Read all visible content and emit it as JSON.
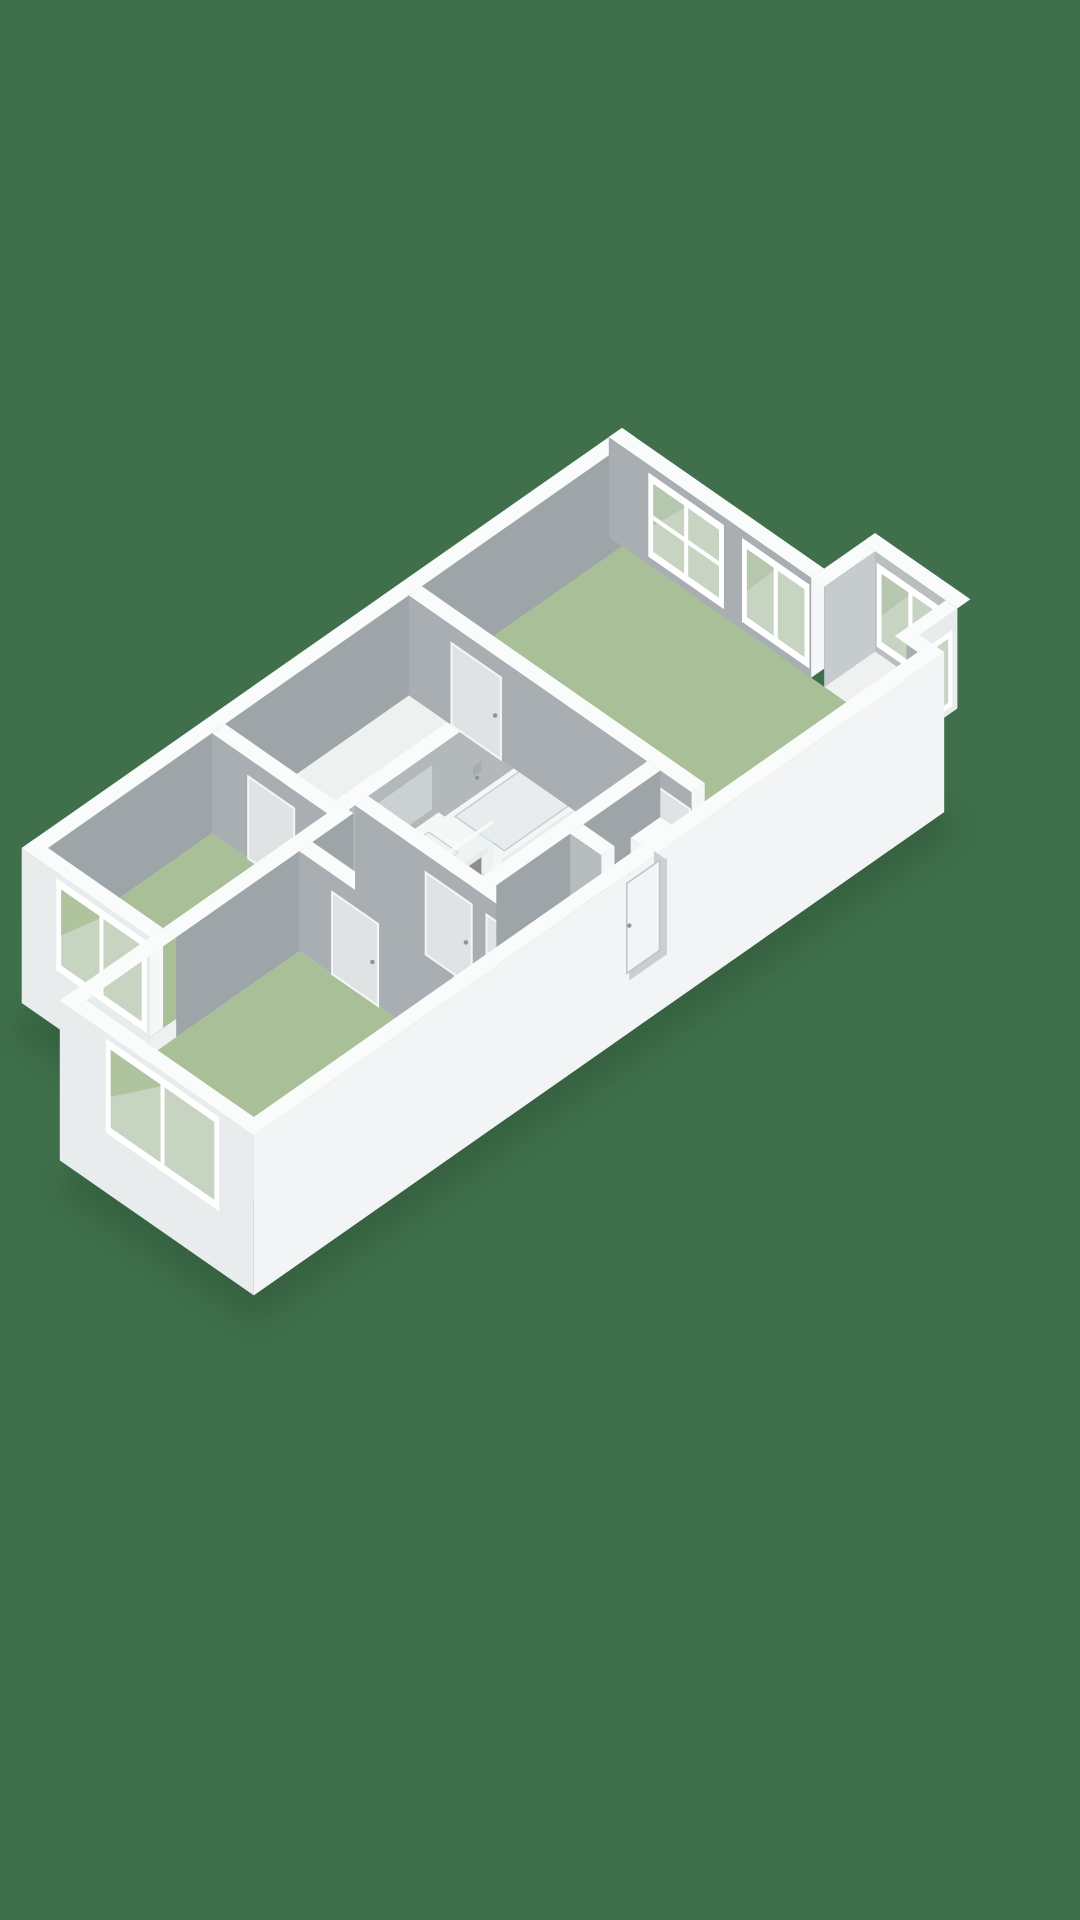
{
  "meta": {
    "title": "3D isometric floor plan"
  },
  "canvas": {
    "width": 1080,
    "height": 1920
  },
  "colors": {
    "bg": "#3F6F4B",
    "shadow": "#2C5136",
    "floor_base": "#EFF1F1",
    "floor_green": "#A9BF98",
    "floor_bath": "#D7DADB",
    "floor_tan": "#B5A893",
    "wall_top": "#FAFBFB",
    "gray_u": "#A8AEB1",
    "gray_v": "#9EA5A8",
    "gray_bath": "#B3B9BB",
    "gray_light": "#C6CCCE",
    "gray_bay": "#B9BFC1",
    "ext_sw": "#E9ECED",
    "ext_se": "#F2F4F5",
    "end_cap": "#F5F7F8",
    "frame": "#FFFFFF",
    "glass": "#C7D4C2",
    "glass_refl": "#B2C5A9",
    "door_panel": "#DFE3E4",
    "door_edge": "#F4F7F7",
    "handle": "#8F969A",
    "recess": "#C9CED0",
    "leaf": "#F2F5F5",
    "leaf_edge": "#BDC3C5",
    "tub": "#F4F6F7",
    "tub_side": "#E9EDEE",
    "basin": "#E8ECEC",
    "basin_edge": "#C8CED0",
    "vanity_front": "#453729",
    "vanity_side": "#372C21",
    "counter": "#F6F8F8",
    "counter_edge": "#E6EAEA",
    "sink": "#F0F3F3",
    "chrome": "#A7ACAF",
    "chrome_dark": "#899094",
    "glass_panel": "#E6EDEE",
    "plant": "#3E6D49",
    "plant_dot": "#86A97F",
    "cab": "#F1F4F4",
    "cab_side": "#E9EDED",
    "shelf": "#E2E8E9"
  },
  "rooms": [
    {
      "id": "living-room",
      "floor": "floor_green"
    },
    {
      "id": "bedroom-1",
      "floor": "floor_green"
    },
    {
      "id": "bedroom-2",
      "floor": "floor_green"
    },
    {
      "id": "bathroom",
      "floor": "floor_bath"
    },
    {
      "id": "closet",
      "floor": "floor_tan"
    },
    {
      "id": "hallway",
      "floor": "floor_base"
    }
  ],
  "fixtures": [
    "bathtub",
    "vanity-unit",
    "bathroom-mirror",
    "wall-faucet",
    "shower-screen",
    "floor-drain",
    "plant",
    "sideboard",
    "glass-shelf",
    "entry-door"
  ],
  "windows": [
    "living-room-window-1",
    "living-room-window-2",
    "bay-window-back",
    "bay-window-side",
    "bedroom-1-window",
    "bedroom-2-window"
  ]
}
